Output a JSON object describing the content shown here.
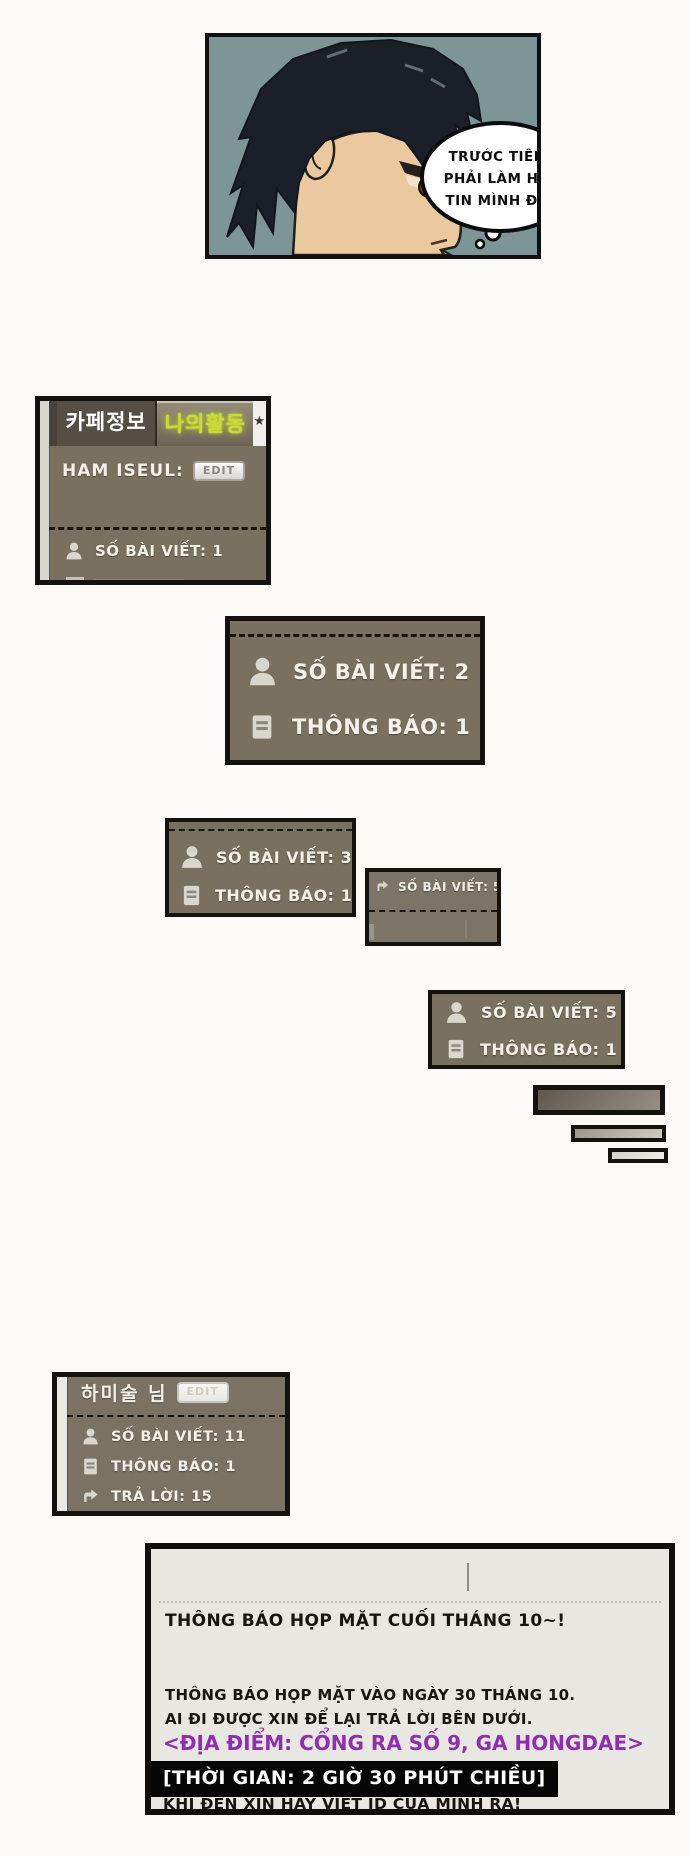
{
  "comic_panel": {
    "bubble_lines": [
      "TRƯỚC TIÊN",
      "PHẢI LÀM HỌ",
      "TIN MÌNH ĐÃ"
    ]
  },
  "cafe_box_1": {
    "tab_cafe_info": "카페정보",
    "tab_my_activity": "나의활동",
    "star": "★",
    "username": "HAM ISEUL:",
    "edit_label": "EDIT",
    "stat_posts": "SỐ BÀI VIẾT: 1"
  },
  "cafe_box_2": {
    "stat_posts": "SỐ BÀI VIẾT: 2",
    "stat_notices": "THÔNG BÁO: 1"
  },
  "cafe_box_3": {
    "stat_posts": "SỐ BÀI VIẾT: 3",
    "stat_notices": "THÔNG BÁO: 1"
  },
  "cafe_box_4": {
    "stat_posts": "SỐ BÀI VIẾT: 5"
  },
  "cafe_box_5": {
    "stat_posts": "SỐ BÀI VIẾT: 5",
    "stat_notices": "THÔNG BÁO: 1"
  },
  "cafe_box_6": {
    "username": "하미술 님",
    "edit_label": "EDIT",
    "stat_posts": "SỐ BÀI VIẾT: 11",
    "stat_notices": "THÔNG BÁO: 1",
    "stat_replies": "TRẢ LỜI: 15"
  },
  "announcement": {
    "title": "THÔNG BÁO HỌP MẶT CUỐI THÁNG 10~!",
    "body_line1": "THÔNG BÁO HỌP MẶT VÀO NGÀY 30 THÁNG 10.",
    "body_line2": "AI ĐI ĐƯỢC XIN ĐỂ LẠI TRẢ LỜI BÊN DƯỚI.",
    "location": "<ĐỊA ĐIỂM: CỔNG RA SỐ 9, GA HONGDAE>",
    "time": "[THỜI GIAN: 2 GIỜ 30 PHÚT CHIỀU]",
    "footer": "KHI ĐẾN XIN HÃY VIẾT ID CỦA MÌNH RA!"
  },
  "colors": {
    "box_background": "#79705f",
    "box_border": "#14120f",
    "box_text": "#f3f1e8",
    "active_tab_text": "#c9dc34",
    "location_text": "#8d2fae",
    "time_bg": "#060606",
    "time_text": "#ffffff",
    "panel_background": "#e9e7e2",
    "comic_background": "#7d9596"
  }
}
